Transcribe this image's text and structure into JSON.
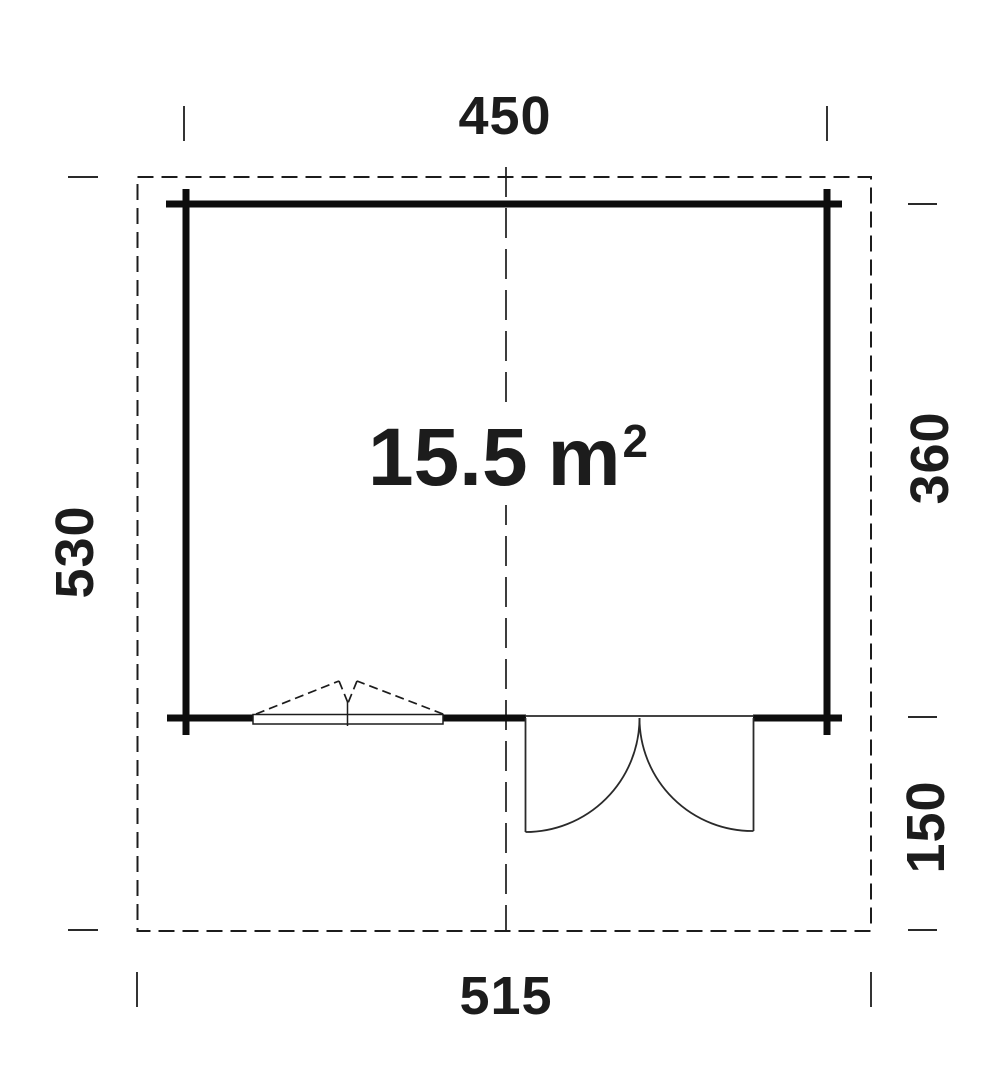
{
  "plan": {
    "area": {
      "value": "15.5",
      "unit": "m",
      "exponent": "2"
    },
    "dimensions": {
      "top": "450",
      "left": "530",
      "right_upper": "360",
      "right_lower": "150",
      "bottom": "515"
    },
    "colors": {
      "line": "#1c1c1c",
      "wall": "#0d0d0d",
      "background": "#ffffff"
    }
  }
}
